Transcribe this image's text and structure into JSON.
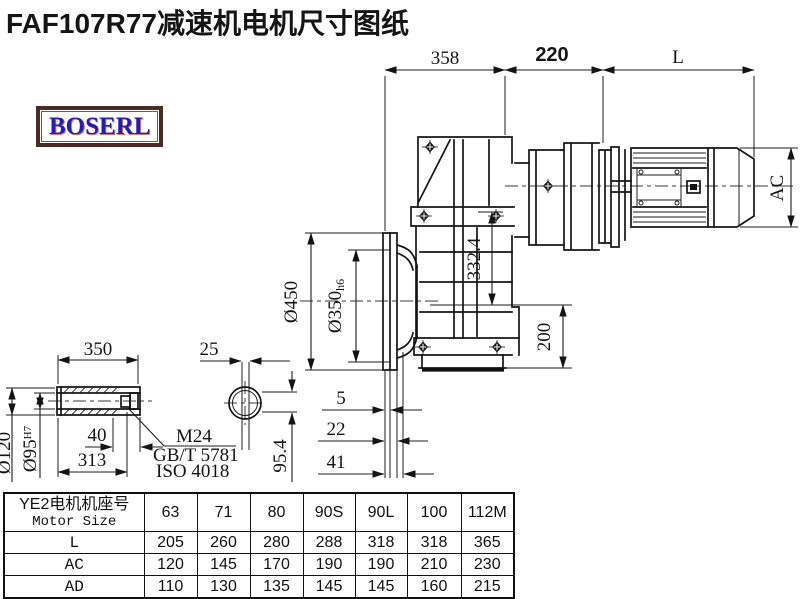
{
  "title": "FAF107R77减速机电机尺寸图纸",
  "logo": {
    "text": "BOSERL"
  },
  "drawing": {
    "dims": {
      "gearbox_width": "358",
      "adapter_width": "220",
      "motor_length": "L",
      "motor_diameter": "AC",
      "flange_outer": "Ø450",
      "flange_spigot": "Ø350",
      "flange_spigot_tol": "h6",
      "center_height": "332.4",
      "bottom_height": "200",
      "shaft_length": "350",
      "key_width": "25",
      "shaft_od": "Ø120",
      "shaft_bore": "Ø95",
      "shaft_bore_tol": "H7",
      "bolt_offset": "40",
      "bore_depth": "313",
      "thread": "M24",
      "thread_std1": "GB/T 5781",
      "thread_std2": "ISO 4018",
      "key_depth": "95.4",
      "flange_step1": "5",
      "flange_step2": "22",
      "flange_step3": "41"
    }
  },
  "table": {
    "header": {
      "title_cn": "YE2电机机座号",
      "title_en": "Motor Size",
      "sizes": [
        "63",
        "71",
        "80",
        "90S",
        "90L",
        "100",
        "112M"
      ]
    },
    "rows": [
      {
        "label": "L",
        "values": [
          "205",
          "260",
          "280",
          "288",
          "318",
          "318",
          "365"
        ]
      },
      {
        "label": "AC",
        "values": [
          "120",
          "145",
          "170",
          "190",
          "190",
          "210",
          "230"
        ]
      },
      {
        "label": "AD",
        "values": [
          "110",
          "130",
          "135",
          "145",
          "145",
          "160",
          "215"
        ]
      }
    ]
  }
}
